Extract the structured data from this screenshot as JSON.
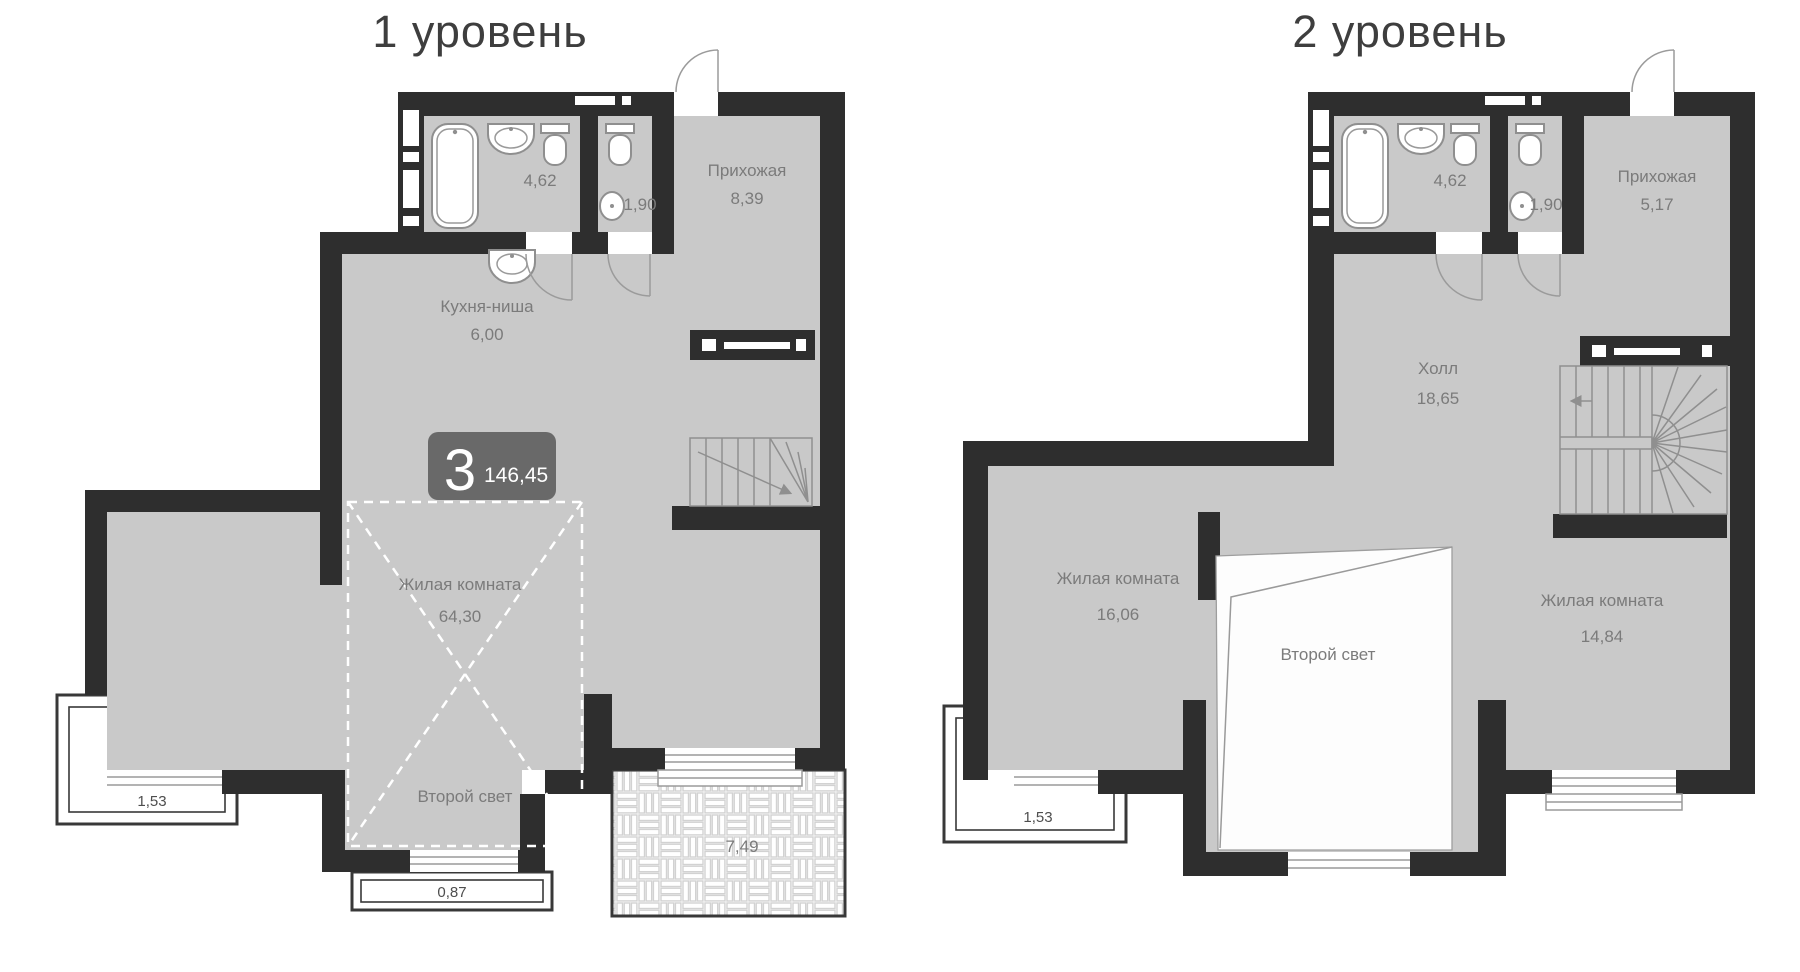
{
  "titles": {
    "level1": "1 уровень",
    "level2": "2 уровень"
  },
  "badge": {
    "rooms": "3",
    "total_area": "146,45"
  },
  "level1": {
    "bath_area": "4,62",
    "wc_area": "1,90",
    "hallway_name": "Прихожая",
    "hallway_area": "8,39",
    "kitchen_name": "Кухня-ниша",
    "kitchen_area": "6,00",
    "living_name": "Жилая комната",
    "living_area": "64,30",
    "void_label": "Второй свет",
    "balcony_area": "1,53",
    "balcony2_area": "0,87",
    "terrace_area": "7,49"
  },
  "level2": {
    "bath_area": "4,62",
    "wc_area": "1,90",
    "hallway_name": "Прихожая",
    "hallway_area": "5,17",
    "hall_name": "Холл",
    "hall_area": "18,65",
    "living1_name": "Жилая комната",
    "living1_area": "16,06",
    "living2_name": "Жилая комната",
    "living2_area": "14,84",
    "void_label": "Второй свет",
    "balcony_area": "1,53"
  },
  "colors": {
    "wall": "#2e2e2e",
    "floor": "#c9c9c9",
    "label": "#7b7b7b",
    "badge_bg": "#696969"
  }
}
